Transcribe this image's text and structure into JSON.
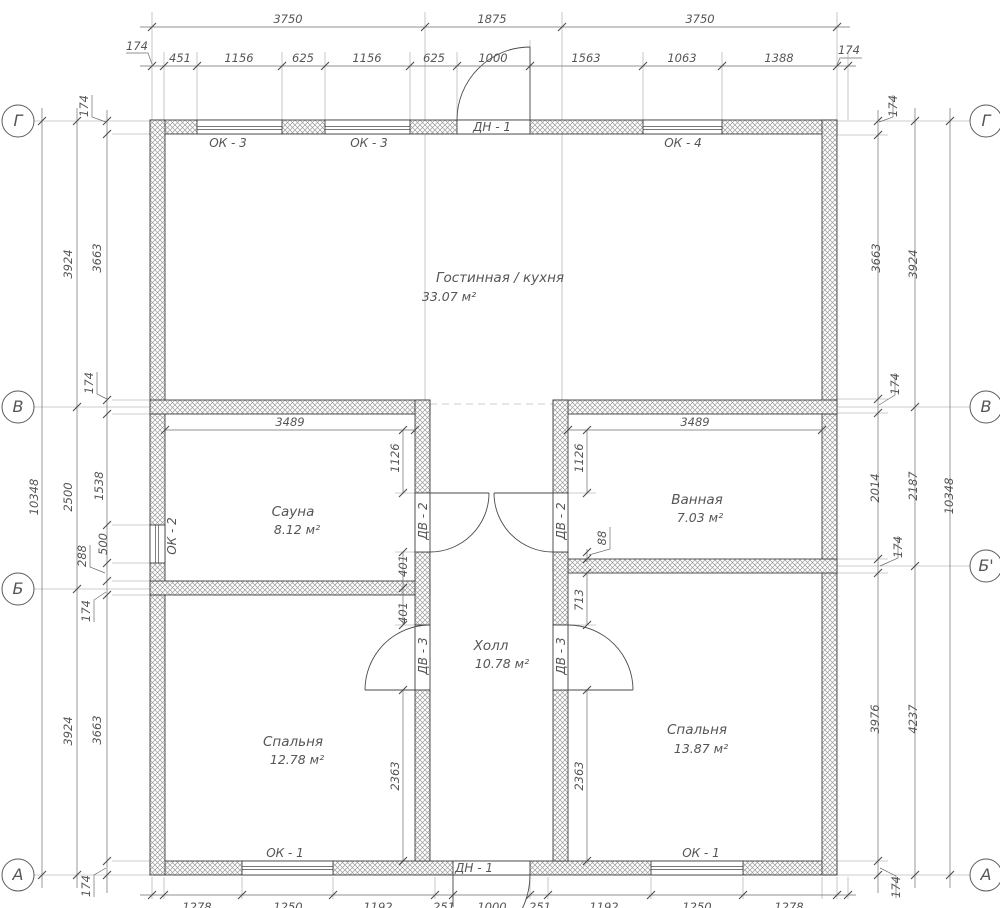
{
  "drawing": {
    "axis_markers": [
      {
        "label": "Г",
        "x": 18,
        "y": 121
      },
      {
        "label": "В",
        "x": 18,
        "y": 407
      },
      {
        "label": "Б",
        "x": 18,
        "y": 589
      },
      {
        "label": "А",
        "x": 18,
        "y": 875
      },
      {
        "label": "Г",
        "x": 986,
        "y": 121
      },
      {
        "label": "В",
        "x": 986,
        "y": 407
      },
      {
        "label": "Б'",
        "x": 986,
        "y": 566
      },
      {
        "label": "А",
        "x": 986,
        "y": 875
      }
    ],
    "rooms": [
      {
        "name": "Гостинная / кухня",
        "area": "33.07 м²",
        "nx": 500,
        "ny": 282,
        "ax": 449,
        "ay": 301
      },
      {
        "name": "Сауна",
        "area": "8.12 м²",
        "nx": 293,
        "ny": 516,
        "ax": 297,
        "ay": 534
      },
      {
        "name": "Ванная",
        "area": "7.03 м²",
        "nx": 697,
        "ny": 504,
        "ax": 700,
        "ay": 522
      },
      {
        "name": "Холл",
        "area": "10.78 м²",
        "nx": 491,
        "ny": 650,
        "ax": 502,
        "ay": 668
      },
      {
        "name": "Спальня",
        "area": "12.78 м²",
        "nx": 293,
        "ny": 746,
        "ax": 297,
        "ay": 764
      },
      {
        "name": "Спальня",
        "area": "13.87 м²",
        "nx": 697,
        "ny": 734,
        "ax": 701,
        "ay": 753
      }
    ],
    "opening_tags": [
      {
        "text": "ОК - 3",
        "x": 228,
        "y": 147
      },
      {
        "text": "ОК - 3",
        "x": 369,
        "y": 147
      },
      {
        "text": "ДН - 1",
        "x": 492,
        "y": 131
      },
      {
        "text": "ОК - 4",
        "x": 683,
        "y": 147
      },
      {
        "text": "ОК - 2",
        "x": 176,
        "y": 536,
        "rot": -90
      },
      {
        "text": "ДВ - 2",
        "x": 427,
        "y": 521,
        "rot": -90
      },
      {
        "text": "ДВ - 2",
        "x": 565,
        "y": 521,
        "rot": -90
      },
      {
        "text": "ДВ - 3",
        "x": 427,
        "y": 656,
        "rot": -90
      },
      {
        "text": "ДВ - 3",
        "x": 565,
        "y": 656,
        "rot": -90
      },
      {
        "text": "ОК - 1",
        "x": 285,
        "y": 857
      },
      {
        "text": "ОК - 1",
        "x": 701,
        "y": 857
      },
      {
        "text": "ДН - 1",
        "x": 474,
        "y": 872
      }
    ],
    "dimensions": [
      {
        "text": "3750",
        "x": 288,
        "y": 23
      },
      {
        "text": "1875",
        "x": 492,
        "y": 23
      },
      {
        "text": "3750",
        "x": 700,
        "y": 23
      },
      {
        "text": "174",
        "x": 137,
        "y": 50
      },
      {
        "text": "174",
        "x": 849,
        "y": 54
      },
      {
        "text": "451",
        "x": 180,
        "y": 62
      },
      {
        "text": "1156",
        "x": 239,
        "y": 62
      },
      {
        "text": "625",
        "x": 303,
        "y": 62
      },
      {
        "text": "1156",
        "x": 367,
        "y": 62
      },
      {
        "text": "625",
        "x": 434,
        "y": 62
      },
      {
        "text": "1000",
        "x": 493,
        "y": 62
      },
      {
        "text": "1563",
        "x": 586,
        "y": 62
      },
      {
        "text": "1063",
        "x": 682,
        "y": 62
      },
      {
        "text": "1388",
        "x": 779,
        "y": 62
      },
      {
        "text": "10348",
        "x": 38,
        "y": 497,
        "rot": -90
      },
      {
        "text": "3924",
        "x": 72,
        "y": 264,
        "rot": -90
      },
      {
        "text": "2500",
        "x": 72,
        "y": 497,
        "rot": -90
      },
      {
        "text": "3924",
        "x": 72,
        "y": 731,
        "rot": -90
      },
      {
        "text": "174",
        "x": 88,
        "y": 106,
        "rot": -90
      },
      {
        "text": "3663",
        "x": 101,
        "y": 258,
        "rot": -90
      },
      {
        "text": "174",
        "x": 93,
        "y": 383,
        "rot": -90
      },
      {
        "text": "1538",
        "x": 103,
        "y": 486,
        "rot": -90
      },
      {
        "text": "500",
        "x": 107,
        "y": 544,
        "rot": -90
      },
      {
        "text": "288",
        "x": 86,
        "y": 556,
        "rot": -90
      },
      {
        "text": "174",
        "x": 90,
        "y": 611,
        "rot": -90
      },
      {
        "text": "3663",
        "x": 101,
        "y": 730,
        "rot": -90
      },
      {
        "text": "174",
        "x": 90,
        "y": 886,
        "rot": -90
      },
      {
        "text": "174",
        "x": 897,
        "y": 106,
        "rot": -90
      },
      {
        "text": "3663",
        "x": 880,
        "y": 258,
        "rot": -90
      },
      {
        "text": "3924",
        "x": 917,
        "y": 264,
        "rot": -90
      },
      {
        "text": "174",
        "x": 899,
        "y": 384,
        "rot": -90
      },
      {
        "text": "2014",
        "x": 879,
        "y": 488,
        "rot": -90
      },
      {
        "text": "2187",
        "x": 917,
        "y": 486,
        "rot": -90
      },
      {
        "text": "10348",
        "x": 953,
        "y": 496,
        "rot": -90
      },
      {
        "text": "174",
        "x": 902,
        "y": 547,
        "rot": -90
      },
      {
        "text": "3976",
        "x": 879,
        "y": 719,
        "rot": -90
      },
      {
        "text": "4237",
        "x": 917,
        "y": 719,
        "rot": -90
      },
      {
        "text": "174",
        "x": 900,
        "y": 887,
        "rot": -90
      },
      {
        "text": "1278",
        "x": 197,
        "y": 911
      },
      {
        "text": "1250",
        "x": 288,
        "y": 911
      },
      {
        "text": "1192",
        "x": 378,
        "y": 911
      },
      {
        "text": "251",
        "x": 444,
        "y": 911
      },
      {
        "text": "1000",
        "x": 492,
        "y": 911
      },
      {
        "text": "251",
        "x": 540,
        "y": 911
      },
      {
        "text": "1192",
        "x": 604,
        "y": 911
      },
      {
        "text": "1250",
        "x": 697,
        "y": 911
      },
      {
        "text": "1278",
        "x": 789,
        "y": 911
      },
      {
        "text": "3489",
        "x": 290,
        "y": 426
      },
      {
        "text": "1126",
        "x": 399,
        "y": 458,
        "rot": -90
      },
      {
        "text": "401",
        "x": 407,
        "y": 566,
        "rot": -90
      },
      {
        "text": "401",
        "x": 407,
        "y": 613,
        "rot": -90
      },
      {
        "text": "2363",
        "x": 399,
        "y": 776,
        "rot": -90
      },
      {
        "text": "3489",
        "x": 695,
        "y": 426
      },
      {
        "text": "1126",
        "x": 583,
        "y": 458,
        "rot": -90
      },
      {
        "text": "88",
        "x": 606,
        "y": 538,
        "rot": -90
      },
      {
        "text": "713",
        "x": 583,
        "y": 600,
        "rot": -90
      },
      {
        "text": "2363",
        "x": 583,
        "y": 776,
        "rot": -90
      }
    ]
  }
}
